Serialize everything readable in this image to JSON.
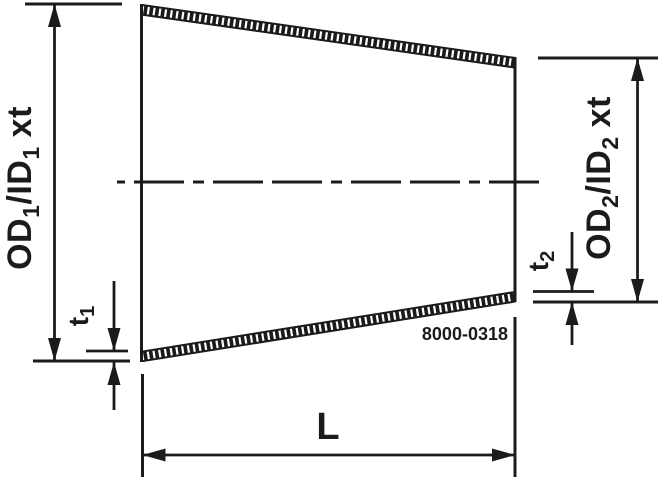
{
  "colors": {
    "line": "#1b1b1b",
    "background": "#ffffff"
  },
  "labels": {
    "od1": {
      "main1": "OD",
      "sub1": "1",
      "main2": "/ID",
      "sub2": "1",
      "main3": "xt"
    },
    "od2": {
      "main1": "OD",
      "sub1": "2",
      "main2": "/ID",
      "sub2": "2",
      "main3": "xt"
    },
    "t1": {
      "main": "t",
      "sub": "1"
    },
    "t2": {
      "main": "t",
      "sub": "2"
    },
    "length": "L",
    "part_number": "8000-0318"
  }
}
